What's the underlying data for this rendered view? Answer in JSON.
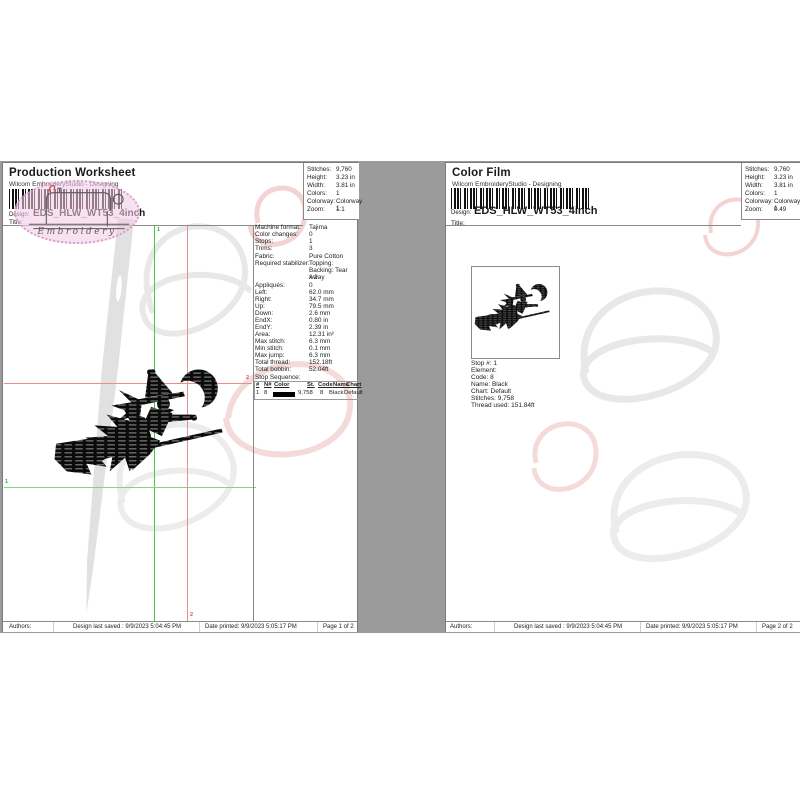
{
  "colors": {
    "green_marker": "#44cc44",
    "red_marker": "#e49090",
    "stamp_pink": "#f3cde9",
    "swatch": "#000000",
    "backdrop": "#9b9b9b"
  },
  "stamp": {
    "brand": "Embroidery"
  },
  "left_page": {
    "title": "Production Worksheet",
    "subtitle": "Wilcom EmbroideryStudio - Designing",
    "design_label": "Design:",
    "design_name": "EDS_HLW_WT53_4inch",
    "doc_title_label": "Title:",
    "stats": [
      {
        "label": "Stitches:",
        "value": "9,760"
      },
      {
        "label": "Height:",
        "value": "3.23 in"
      },
      {
        "label": "Width:",
        "value": "3.81 in"
      },
      {
        "label": "Colors:",
        "value": "1"
      },
      {
        "label": "Colorway:",
        "value": "Colorway 1"
      },
      {
        "label": "Zoom:",
        "value": "1:1"
      }
    ],
    "details": [
      {
        "label": "Machine format:",
        "value": "Tajima"
      },
      {
        "label": "Color changes:",
        "value": "0"
      },
      {
        "label": "Stops:",
        "value": "1"
      },
      {
        "label": "Trims:",
        "value": "3"
      },
      {
        "label": "Fabric:",
        "value": "Pure Cotton"
      },
      {
        "label": "Required stabilizer:",
        "value": "Topping:"
      },
      {
        "label": "",
        "value": "Backing: Tear Away"
      },
      {
        "label": "",
        "value": "x 2"
      },
      {
        "label": "Appliqués:",
        "value": "0"
      },
      {
        "label": "Left:",
        "value": "62.0 mm"
      },
      {
        "label": "Right:",
        "value": "34.7 mm"
      },
      {
        "label": "Up:",
        "value": "79.5 mm"
      },
      {
        "label": "Down:",
        "value": "2.6 mm"
      },
      {
        "label": "EndX:",
        "value": "0.80 in"
      },
      {
        "label": "EndY:",
        "value": "2.39 in"
      },
      {
        "label": "Area:",
        "value": "12.31 in²"
      },
      {
        "label": "Max stitch:",
        "value": "6.3 mm"
      },
      {
        "label": "Min stitch:",
        "value": "0.1 mm"
      },
      {
        "label": "Max jump:",
        "value": "6.3 mm"
      },
      {
        "label": "Total thread:",
        "value": "152.18ft"
      },
      {
        "label": "Total bobbin:",
        "value": "52.04ft"
      }
    ],
    "stop_sequence": {
      "heading": "Stop Sequence:",
      "headers": [
        "#",
        "N#",
        "Color",
        "St.",
        "Code",
        "Name",
        "Chart"
      ],
      "row": {
        "num": "1",
        "n": "8",
        "stitches": "9,758",
        "code": "8",
        "name": "Black",
        "chart": "Default"
      }
    },
    "markers": {
      "start": "1",
      "end": "2"
    },
    "footer": {
      "authors": "Authors:",
      "saved": "Design last saved : 9/9/2023 5:04:45 PM",
      "printed": "Date printed: 9/9/2023 5:05:17 PM",
      "page": "Page 1 of 2"
    }
  },
  "right_page": {
    "title": "Color Film",
    "subtitle": "Wilcom EmbroideryStudio - Designing",
    "design_label": "Design:",
    "design_name": "EDS_HLW_WT53_4inch",
    "doc_title_label": "Title:",
    "stats": [
      {
        "label": "Stitches:",
        "value": "9,760"
      },
      {
        "label": "Height:",
        "value": "3.23 in"
      },
      {
        "label": "Width:",
        "value": "3.81 in"
      },
      {
        "label": "Colors:",
        "value": "1"
      },
      {
        "label": "Colorway:",
        "value": "Colorway 1"
      },
      {
        "label": "Zoom:",
        "value": "0.49"
      }
    ],
    "stop_details": [
      "Stop #: 1",
      "Element:",
      "Code: 8",
      "Name: Black",
      "Chart: Default",
      "Stitches: 9,758",
      "Thread used: 151.84ft"
    ],
    "footer": {
      "authors": "Authors:",
      "saved": "Design last saved : 9/9/2023 5:04:45 PM",
      "printed": "Date printed: 9/9/2023 5:05:17 PM",
      "page": "Page 2 of 2"
    }
  }
}
